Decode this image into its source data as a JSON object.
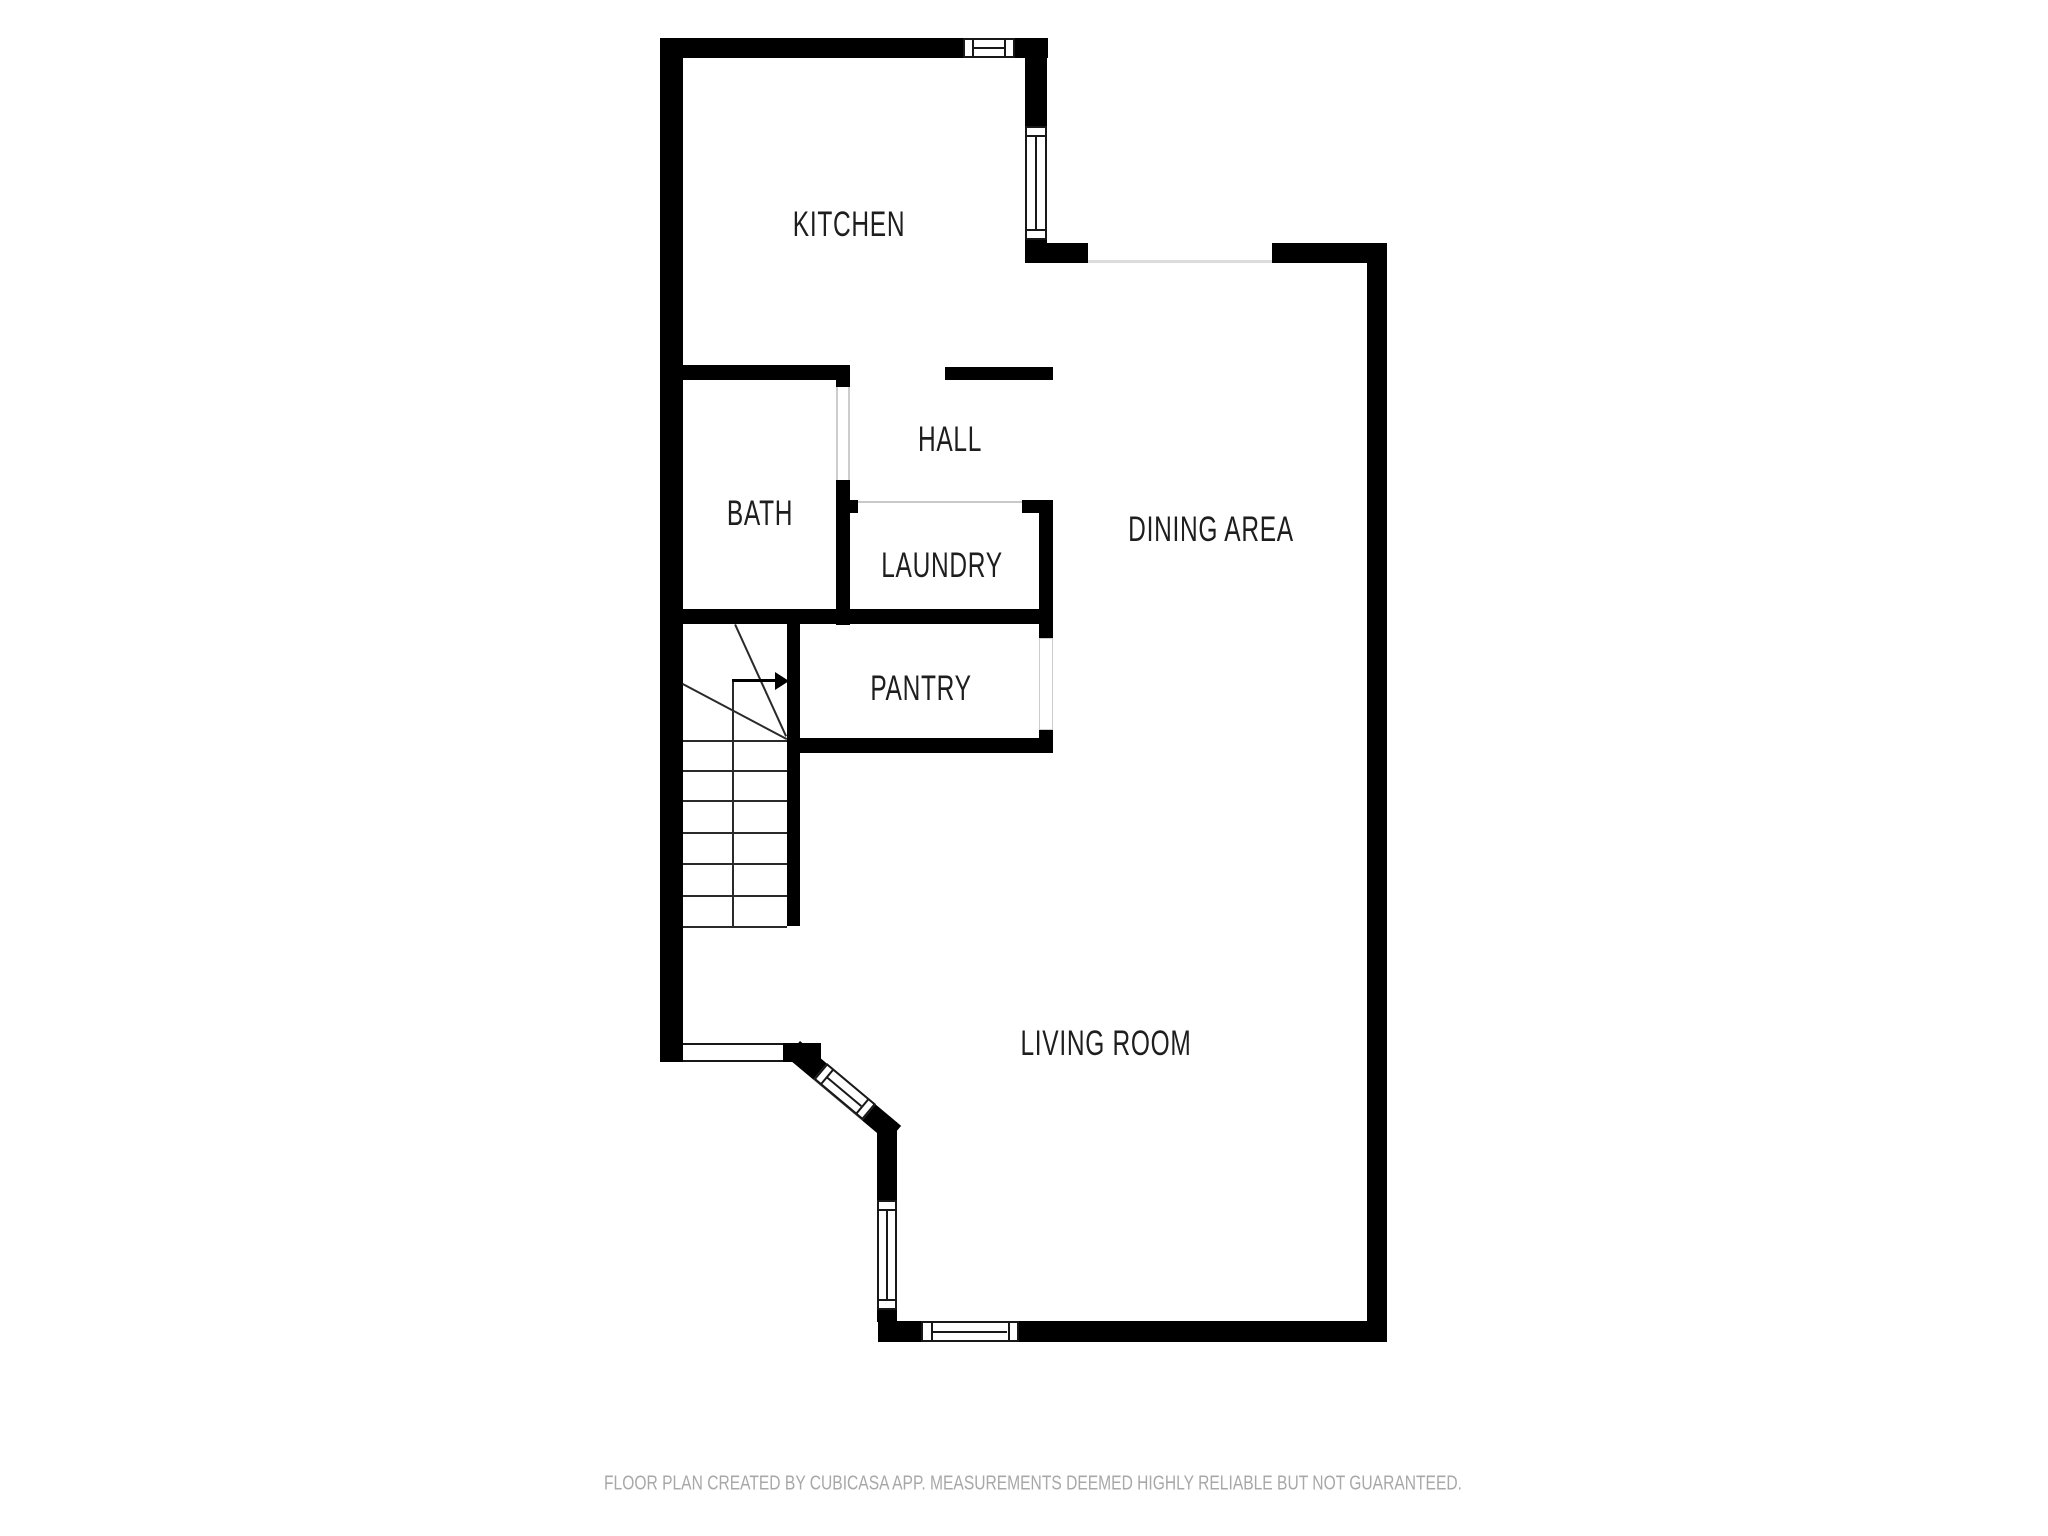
{
  "rooms": {
    "kitchen": {
      "label": "KITCHEN"
    },
    "hall": {
      "label": "HALL"
    },
    "bath": {
      "label": "BATH"
    },
    "laundry": {
      "label": "LAUNDRY"
    },
    "dining": {
      "label": "DINING AREA"
    },
    "pantry": {
      "label": "PANTRY"
    },
    "living": {
      "label": "LIVING ROOM"
    }
  },
  "footer": {
    "text": "FLOOR PLAN CREATED BY CUBICASA APP. MEASUREMENTS DEEMED HIGHLY RELIABLE BUT NOT GUARANTEED."
  },
  "colors": {
    "wall": "#000000",
    "stair-line": "#2a2a2a",
    "opening-line": "#dcdcdc",
    "jamb": "#cccccc",
    "window-frame": "#181818",
    "label": "#1e1e1e",
    "footer": "#a8a8a8",
    "background": "#ffffff"
  }
}
